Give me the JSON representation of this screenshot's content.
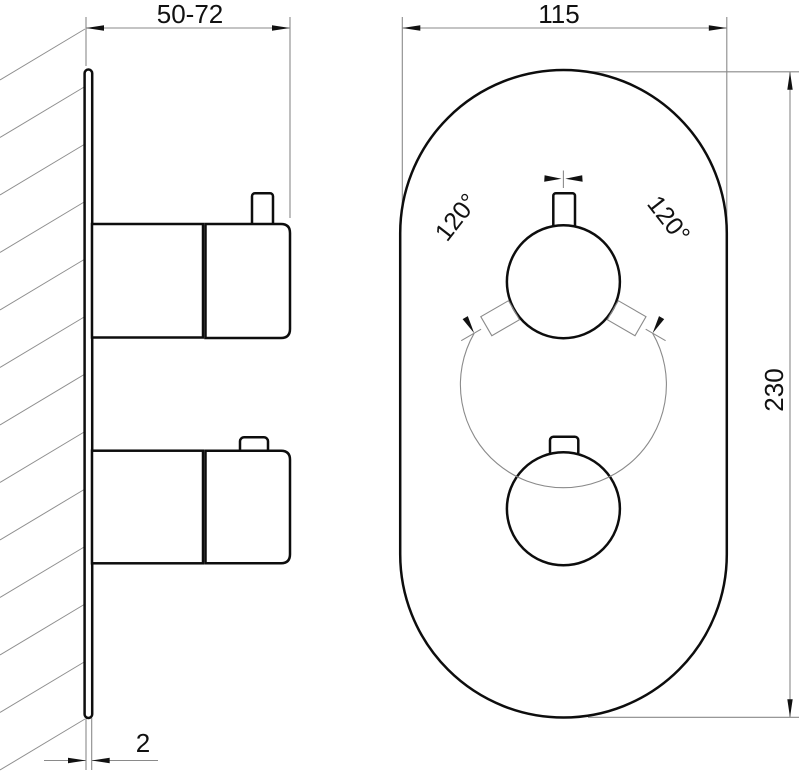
{
  "dimensions": {
    "depth_range": "50-72",
    "plate_width": "115",
    "plate_height": "230",
    "plate_thickness": "2",
    "rotation_left": "120°",
    "rotation_right": "120°"
  }
}
